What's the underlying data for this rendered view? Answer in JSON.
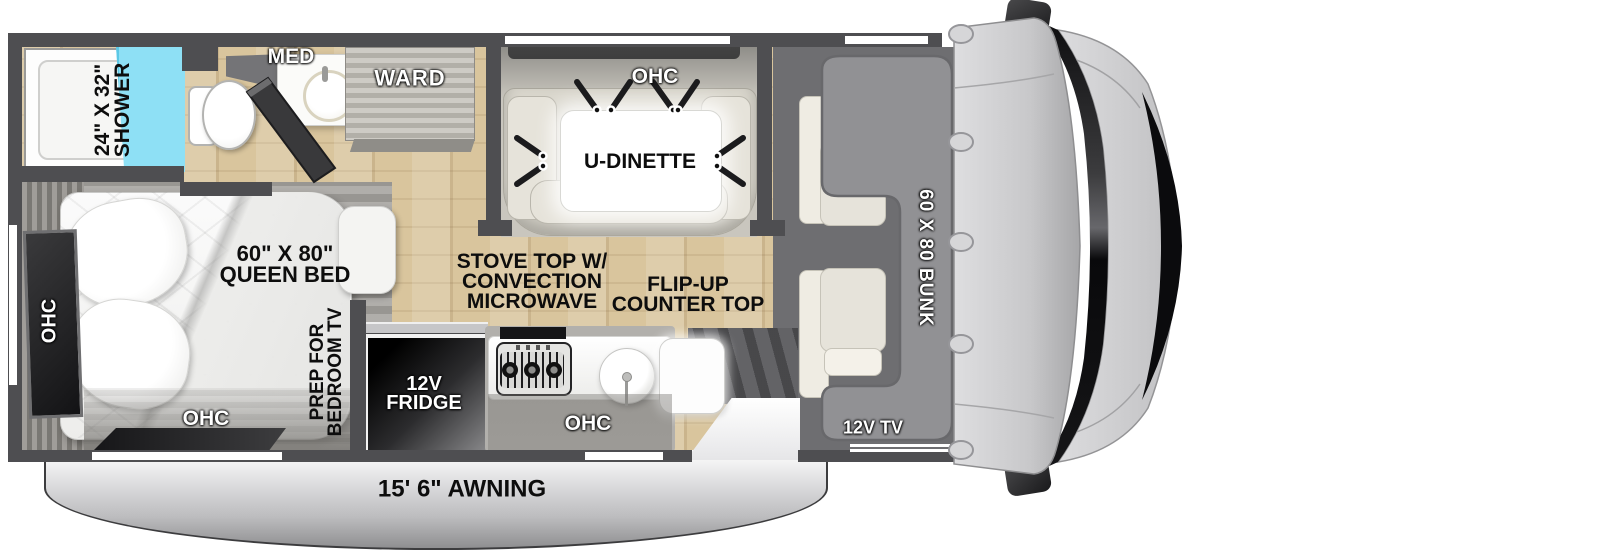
{
  "title": "RV floor plan with cab-over bunk",
  "colors": {
    "wall": "#4e4e51",
    "wood_floor": "#d9c59d",
    "shower_glass": "#8ee0f5",
    "bunk_gray": "#919194",
    "seat_beige": "#e4e1d8",
    "fridge_black": "#1a1a1c",
    "awning_silver": "#c9c9cb",
    "label_black": "#0d0d0d",
    "label_white": "#ffffff"
  },
  "bathroom": {
    "shower_size": "24\" X 32\"",
    "shower_name": "SHOWER",
    "med": "MED",
    "ward": "WARD"
  },
  "dinette": {
    "ohc": "OHC",
    "table": "U-DINETTE"
  },
  "bedroom": {
    "ohc_side": "OHC",
    "ohc_bottom": "OHC",
    "bed_size": "60\" X 80\"",
    "bed_name": "QUEEN BED",
    "prep_line1": "PREP FOR",
    "prep_line2": "BEDROOM TV"
  },
  "kitchen": {
    "stove_line1": "STOVE TOP W/",
    "stove_line2": "CONVECTION",
    "stove_line3": "MICROWAVE",
    "flip_line1": "FLIP-UP",
    "flip_line2": "COUNTER TOP",
    "fridge_line1": "12V",
    "fridge_line2": "FRIDGE",
    "ohc": "OHC"
  },
  "cab": {
    "bunk": "60 X 80 BUNK",
    "tv": "12V TV"
  },
  "exterior": {
    "awning": "15' 6\" AWNING"
  }
}
